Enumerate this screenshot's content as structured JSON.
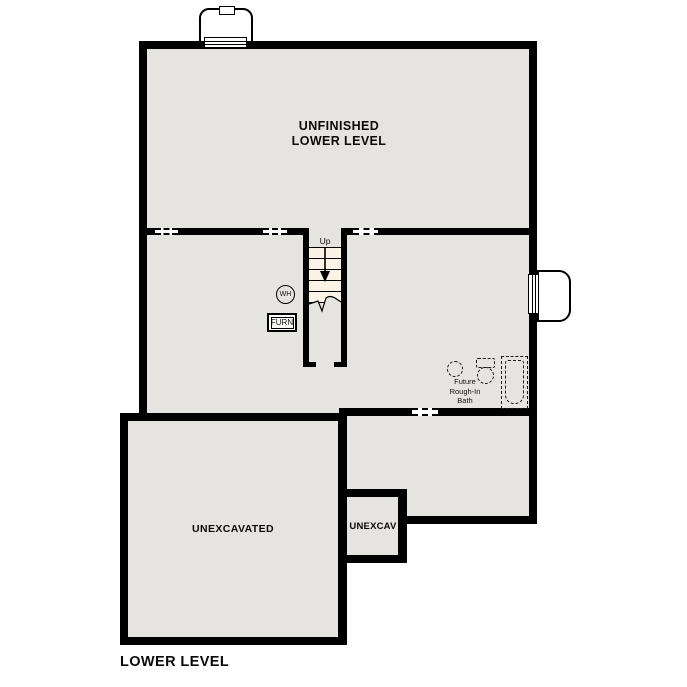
{
  "plan": {
    "title": "LOWER LEVEL",
    "rooms": {
      "unfinished": {
        "line1": "UNFINISHED",
        "line2": "LOWER LEVEL"
      },
      "unexcavated": {
        "label": "UNEXCAVATED"
      },
      "unexcav": {
        "label": "UNEXCAV"
      }
    },
    "stairs": {
      "direction_label": "Up"
    },
    "equipment": {
      "water_heater_label": "WH",
      "furnace_label": "FURN"
    },
    "future_bath": {
      "line1": "Future",
      "line2": "Rough-In",
      "line3": "Bath"
    }
  },
  "colors": {
    "wall": "#000000",
    "floor": "#e6e4e1",
    "stair_tread": "#faf3e6",
    "background": "#ffffff"
  }
}
